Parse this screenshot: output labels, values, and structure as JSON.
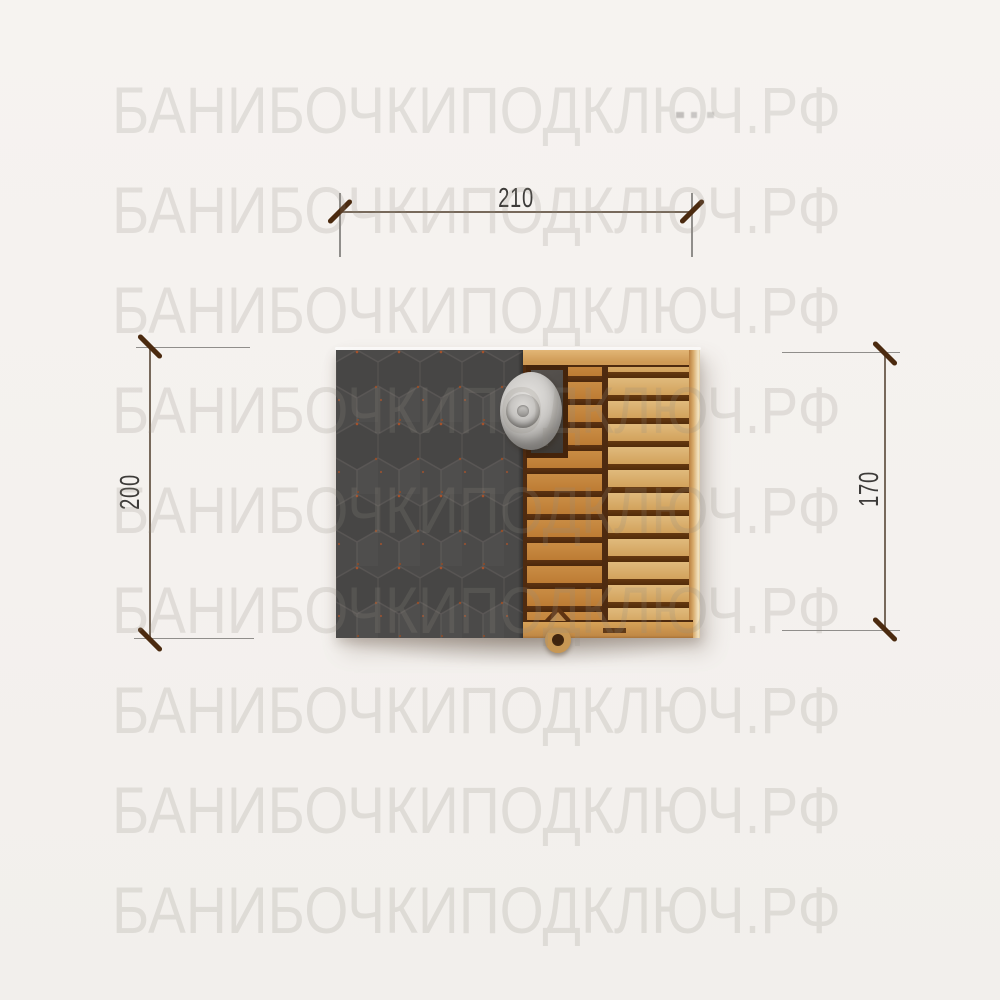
{
  "watermark": {
    "text": "БАНИБОЧКИПОДКЛЮЧ.РФ"
  },
  "dimensions": {
    "top": {
      "label": "210"
    },
    "left": {
      "label": "200"
    },
    "right": {
      "label": "170"
    }
  },
  "figure": {
    "subject": "top view of a barrel sauna",
    "parts": {
      "roof": "dark gray hexagonal shingle roof",
      "deck": "wooden plank deck with frame",
      "chimney": "round metal chimney cap",
      "door_handle": "wooden ring handle at bottom edge"
    }
  },
  "colors": {
    "background": "#f5f2ef",
    "roof": "#4b4a49",
    "roof_hex_line": "#5b5856",
    "roof_speckle": "#b05328",
    "wood_dark_planks": "#c6873f",
    "wood_light_planks": "#deb678",
    "wood_frame": "#d8a765",
    "plank_gap": "#5a3012",
    "chimney_gray": "#c7c5c2",
    "dimension_tick": "#4b2a0f",
    "dimension_line": "#77695b",
    "dimension_text": "#3d3b39",
    "watermark": "rgba(146,138,131,0.20)"
  }
}
